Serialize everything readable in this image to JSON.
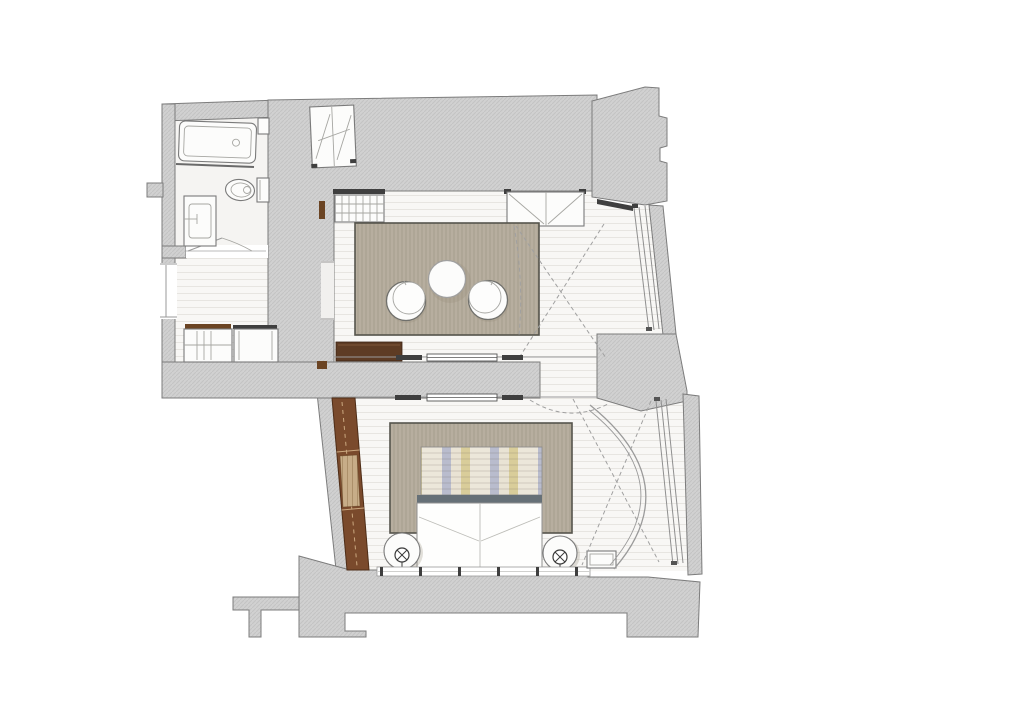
{
  "document": {
    "kind": "architectural-floor-plan",
    "view": "top-down furnished plan of a suite",
    "page_background": "#ffffff"
  },
  "colors": {
    "wall_fill": "#d1d1d1",
    "wall_hatch": "#c3c3c3",
    "wall_stroke": "#7c7c7c",
    "floor_fill": "#f8f7f5",
    "plank_line": "#e7e5e1",
    "rug_fill": "#b7ae9f",
    "rug_texture_line": "rgba(88,78,58,0.18)",
    "rug_border": "#55544c",
    "fixture_stroke": "#7a7a7a",
    "dark_tick": "#3f3f3f",
    "console_brown": "#5e3c24",
    "jamb_brown": "#6b4423",
    "wardrobe_brown": "#7a4a2c",
    "wardrobe_stroke": "#4e2d17",
    "wardrobe_dash": "#caa77f",
    "wood_inset": "#c7ad88",
    "wood_grain": "rgba(120,90,50,0.35)",
    "headboard_band": "#667077",
    "stripe_a": "#ece7da",
    "stripe_b": "#b9bccd",
    "stripe_c": "#e9e3d4",
    "stripe_d": "#d9cd9a",
    "dash_line": "#a0a0a0",
    "arc_line": "#9a9a9a"
  },
  "scene": {
    "rooms": [
      {
        "name": "bathroom",
        "position": "top-left",
        "fixtures": [
          "bathtub",
          "toilet",
          "vanity-sink",
          "shower-screen",
          "wall-niche",
          "swing-door"
        ]
      },
      {
        "name": "entry-hall",
        "position": "left-middle",
        "fixtures": [
          "built-in-closet-grid",
          "built-in-closet-plain",
          "sliding-door-track",
          "entry-door"
        ]
      },
      {
        "name": "living-room",
        "position": "center-top",
        "fixtures": [
          "area-rug",
          "round-table",
          "lounge-chair-left",
          "lounge-chair-right",
          "radiator-grid",
          "storage-cabinet",
          "media-console",
          "angled-window-bay",
          "hatched-wardrobe-closet"
        ]
      },
      {
        "name": "bedroom",
        "position": "center-bottom",
        "fixtures": [
          "double-bed",
          "striped-headboard",
          "area-rug",
          "nightstand-lamp-left",
          "nightstand-lamp-right",
          "tall-brown-wardrobe",
          "window-sill-row",
          "window-bench",
          "curved-drape-arc",
          "angled-window-wall"
        ]
      }
    ],
    "counts": {
      "lounge_chairs": 2,
      "nightstands": 2,
      "closets": 3
    }
  }
}
